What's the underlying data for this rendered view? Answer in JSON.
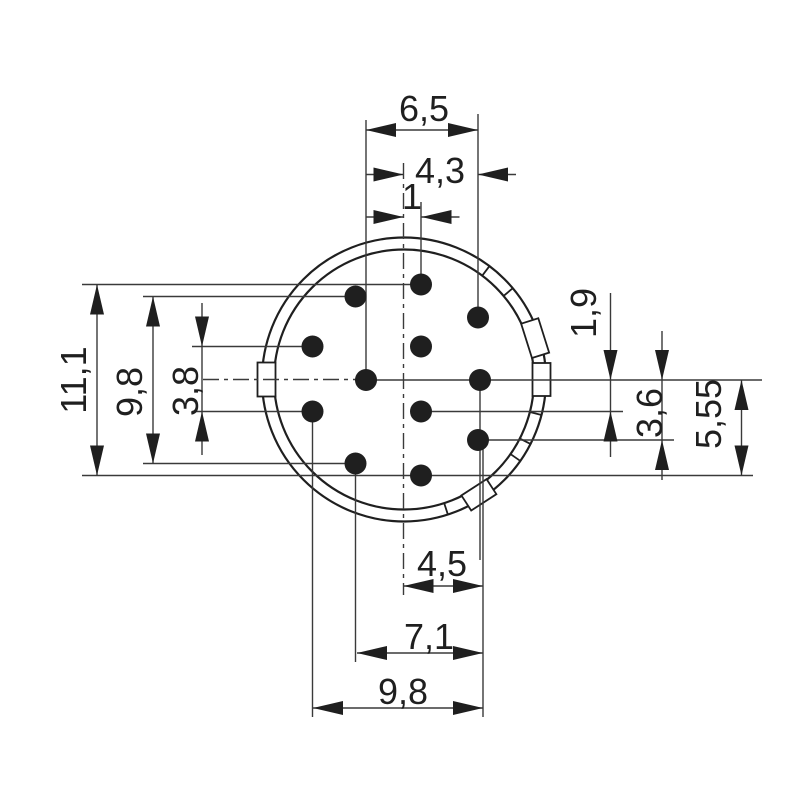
{
  "page": {
    "background": "#ffffff"
  },
  "drawing": {
    "type": "connector-insert-pin-layout-technical-drawing",
    "pin_count": 12,
    "colors": {
      "object_line": "#1f1f1f",
      "dim_line": "#3a3a3a",
      "pin_fill": "#1f1f1f",
      "text": "#1f1f1f",
      "background": "#ffffff"
    },
    "dimension_labels": {
      "top": [
        "6,5",
        "4,3",
        "1"
      ],
      "left": [
        "11,1",
        "9,8",
        "3,8"
      ],
      "right": [
        "1,9",
        "3,6",
        "5,55"
      ],
      "bottom": [
        "4,5",
        "7,1",
        "9,8"
      ]
    },
    "geometry": {
      "canvas": {
        "w": 800,
        "h": 800
      },
      "circle": {
        "cx": 404,
        "cy": 379.5,
        "r_outer": 142,
        "r_inner": 130
      },
      "keyway_radial": [
        128.5,
        146.5
      ],
      "ring_ticks_deg": [
        -53,
        -40,
        14.5,
        27,
        35,
        72
      ],
      "keyways": [
        {
          "deg": -17.5,
          "w": 36
        },
        {
          "deg": 0,
          "w": 33
        },
        {
          "deg": 57,
          "w": 30
        },
        {
          "deg": 180,
          "w": 34
        }
      ],
      "pins": [
        [
          421,
          284.5
        ],
        [
          355.5,
          296.5
        ],
        [
          478,
          317.5
        ],
        [
          312.5,
          346.5
        ],
        [
          421,
          346.5
        ],
        [
          366,
          380
        ],
        [
          480,
          380
        ],
        [
          312.5,
          411.5
        ],
        [
          421,
          411.5
        ],
        [
          478,
          440
        ],
        [
          355.5,
          463.5
        ],
        [
          421,
          475.5
        ]
      ],
      "pin_radius": 11,
      "arrow": {
        "len": 30,
        "hw": 7
      },
      "lines": [
        [
          82,
          284.5,
          421,
          284.5
        ],
        [
          143,
          296.5,
          355.5,
          296.5
        ],
        [
          192,
          346.5,
          312.5,
          346.5
        ],
        [
          192,
          411.5,
          312.5,
          411.5
        ],
        [
          143,
          463.5,
          355.5,
          463.5
        ],
        [
          82,
          475.5,
          753,
          475.5
        ],
        [
          366,
          380,
          762,
          380
        ],
        [
          421,
          411.5,
          623,
          411.5
        ],
        [
          478,
          440,
          674,
          440
        ],
        [
          366,
          120,
          366,
          380
        ],
        [
          421,
          202,
          421,
          284.5
        ],
        [
          478,
          114,
          478,
          317.5
        ],
        [
          312.5,
          411.5,
          312.5,
          717
        ],
        [
          355.5,
          463.5,
          355.5,
          662
        ],
        [
          480,
          380,
          480,
          560
        ],
        [
          483,
          441,
          483,
          717
        ]
      ],
      "centerlines": [
        [
          403.5,
          163,
          403.5,
          595
        ],
        [
          203,
          379.5,
          358,
          379.5
        ]
      ],
      "dims": [
        {
          "id": "dim-6-5",
          "type": "h-in",
          "y": 130,
          "a": 366,
          "b": 478,
          "label": "6,5",
          "lx": 424,
          "ly": 121
        },
        {
          "id": "dim-4-3",
          "type": "h-out",
          "y": 174.5,
          "a": 403.5,
          "b": 478,
          "label": "4,3",
          "lx": 440,
          "ly": 183,
          "stub": 38
        },
        {
          "id": "dim-1",
          "type": "h-out",
          "y": 217,
          "a": 403.5,
          "b": 421.5,
          "label": "1",
          "lx": 412,
          "ly": 209,
          "stub": 38
        },
        {
          "id": "dim-11-1",
          "type": "v-in",
          "x": 97,
          "a": 284.5,
          "b": 475.5,
          "label": "11,1",
          "lx": 86,
          "ly": 380,
          "rot": true
        },
        {
          "id": "dim-9-8-left",
          "type": "v-in",
          "x": 153,
          "a": 296.5,
          "b": 463.5,
          "label": "9,8",
          "lx": 142,
          "ly": 392,
          "rot": true
        },
        {
          "id": "dim-3-8",
          "type": "v-out",
          "x": 202,
          "a": 346.5,
          "b": 411.5,
          "label": "3,8",
          "lx": 198,
          "ly": 391,
          "rot": true,
          "shaft": [
            303,
            455
          ]
        },
        {
          "id": "dim-1-9",
          "type": "v-out",
          "x": 610.5,
          "a": 380,
          "b": 411.5,
          "label": "1,9",
          "lx": 596,
          "ly": 313,
          "rot": true,
          "shaft": [
            293,
            457
          ]
        },
        {
          "id": "dim-3-6",
          "type": "v-out",
          "x": 662,
          "a": 380,
          "b": 440,
          "label": "3,6",
          "lx": 662,
          "ly": 413,
          "rot": true,
          "shaft": [
            331,
            480
          ]
        },
        {
          "id": "dim-5-55",
          "type": "v-in",
          "x": 741.5,
          "a": 380,
          "b": 475.5,
          "label": "5,55",
          "lx": 721,
          "ly": 414,
          "rot": true
        },
        {
          "id": "dim-4-5",
          "type": "h-in",
          "y": 586,
          "a": 403.5,
          "b": 483,
          "label": "4,5",
          "lx": 442,
          "ly": 576
        },
        {
          "id": "dim-7-1",
          "type": "h-in",
          "y": 653,
          "a": 357,
          "b": 483,
          "label": "7,1",
          "lx": 429,
          "ly": 649
        },
        {
          "id": "dim-9-8-bottom",
          "type": "h-in",
          "y": 708,
          "a": 313,
          "b": 483,
          "label": "9,8",
          "lx": 403,
          "ly": 704
        }
      ]
    }
  }
}
